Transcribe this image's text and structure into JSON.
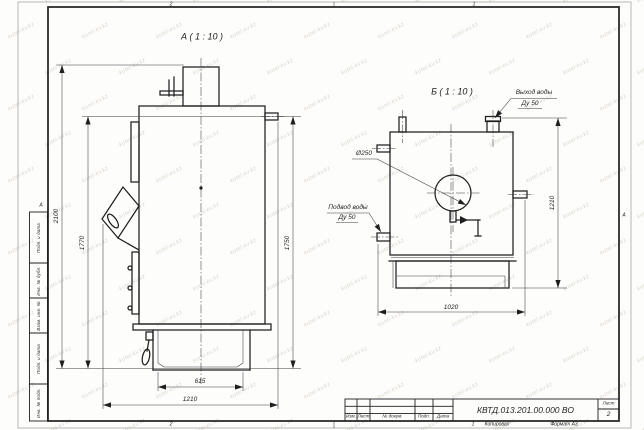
{
  "watermark": {
    "text": "kotel-kv.kz"
  },
  "frame": {
    "zones": {
      "top_left": "2",
      "top_right": "1",
      "bottom_left": "2",
      "bottom_right": "1",
      "left": "А",
      "right": "А"
    },
    "side_column": [
      "Подп. и дата",
      "Инв. № дубл.",
      "Взам. инв. №",
      "Подп. и дата",
      "Инв. № подл."
    ]
  },
  "title_block": {
    "doc_number": "КВТД.013.201.00.000 ВО",
    "sheet_label": "Лист",
    "sheet_number": "2",
    "columns": [
      "Изм.",
      "Лист",
      "№ докум.",
      "Подп.",
      "Дата"
    ],
    "copied_label": "Копировал",
    "format_label": "Формат А3"
  },
  "view_a": {
    "title": "А ( 1 : 10 )",
    "dim_total_height": "2100",
    "dim_height_1770": "1770",
    "dim_height_1750": "1750",
    "dim_base_width": "615",
    "dim_depth": "1210"
  },
  "view_b": {
    "title": "Б ( 1 : 10 )",
    "outlet_label_1": "Выход воды",
    "outlet_label_2": "Ду 50",
    "inlet_label_1": "Подвод воды",
    "inlet_label_2": "Ду 50",
    "dim_diameter": "Ø250",
    "dim_width": "1020",
    "dim_height": "1210"
  },
  "colors": {
    "ink": "#1f1f1f",
    "thin_line": "#3c3c3c",
    "watermark": "#b9ad97"
  }
}
